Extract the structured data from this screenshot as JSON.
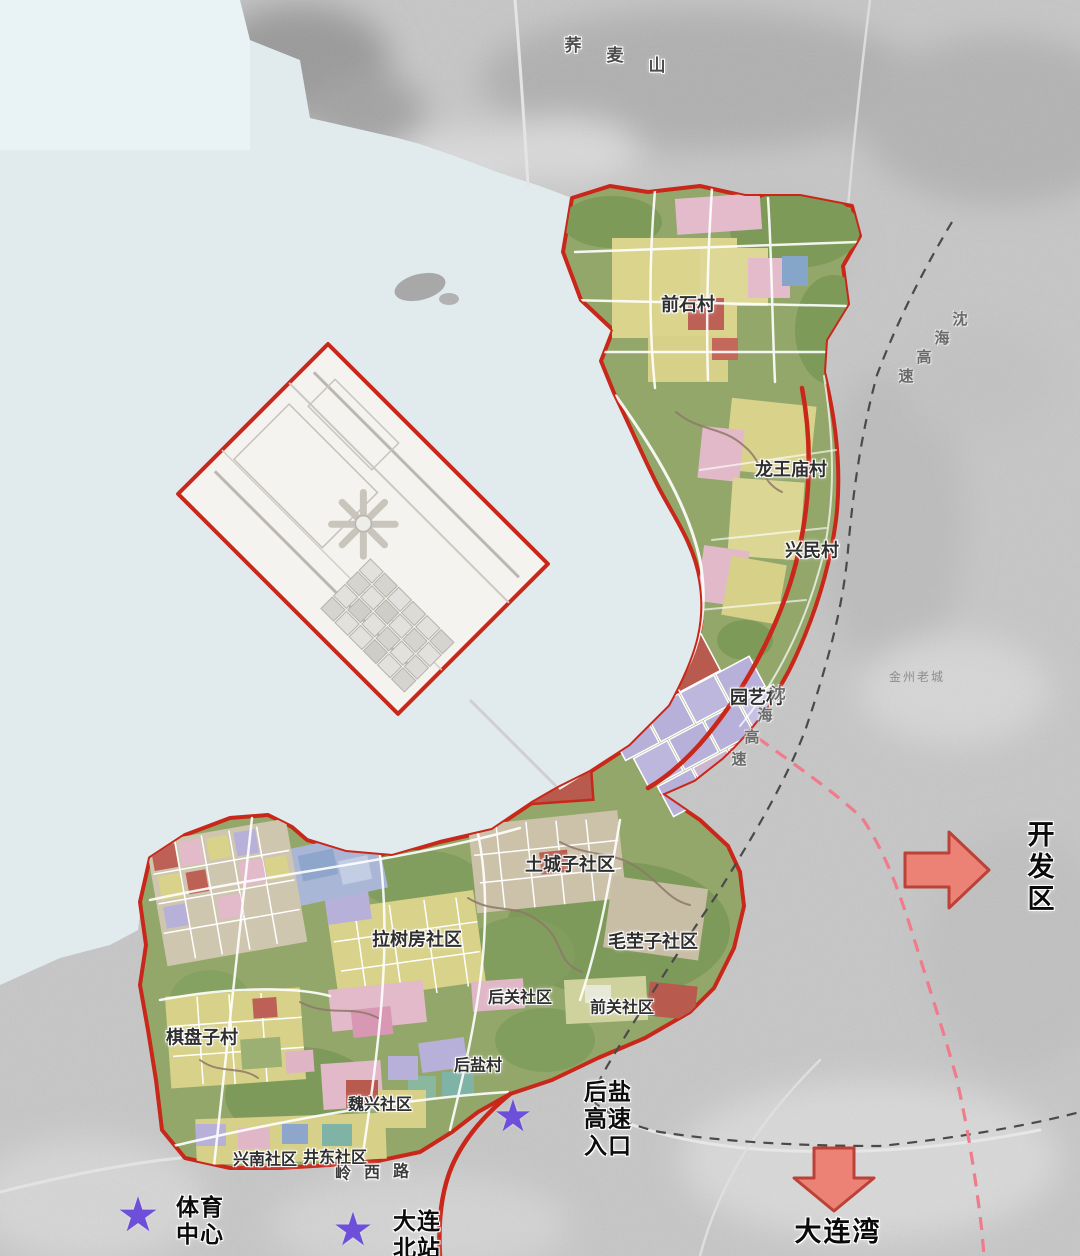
{
  "map": {
    "description_labels": {
      "note": "urban planning map over satellite imagery"
    },
    "labels": [
      {
        "id": "qiaomai-mountain",
        "text": "荞麦山",
        "x": 573,
        "y": 46,
        "cls": "mountain",
        "char_dx": 42,
        "char_dy": 10
      },
      {
        "id": "qianshi-village",
        "text": "前石村",
        "x": 688,
        "y": 305,
        "cls": "zone"
      },
      {
        "id": "longwangmiao-village",
        "text": "龙王庙村",
        "x": 791,
        "y": 470,
        "cls": "zone"
      },
      {
        "id": "xingmin-village",
        "text": "兴民村",
        "x": 812,
        "y": 551,
        "cls": "zone"
      },
      {
        "id": "yuanyi-village",
        "text": "园艺村",
        "x": 757,
        "y": 698,
        "cls": "zone"
      },
      {
        "id": "shenhai-expressway-north",
        "text": "沈海高速",
        "x": 960,
        "y": 320,
        "cls": "road-grey",
        "char_dx": -18,
        "char_dy": 19
      },
      {
        "id": "shenhai-expressway-mid",
        "text": "沈海高速",
        "x": 778,
        "y": 694,
        "cls": "road-grey",
        "char_dx": -13,
        "char_dy": 22
      },
      {
        "id": "jinzhou-old-town",
        "text": "金州老城",
        "x": 917,
        "y": 677,
        "cls": "faint"
      },
      {
        "id": "tuchengzi-community",
        "text": "土城子社区",
        "x": 570,
        "y": 865,
        "cls": "zone"
      },
      {
        "id": "maoyingzi-community",
        "text": "毛茔子社区",
        "x": 653,
        "y": 942,
        "cls": "zone"
      },
      {
        "id": "lashufang-community",
        "text": "拉树房社区",
        "x": 417,
        "y": 940,
        "cls": "zone"
      },
      {
        "id": "houguan-community",
        "text": "后关社区",
        "x": 520,
        "y": 998,
        "cls": "zone-sm"
      },
      {
        "id": "qianguan-community",
        "text": "前关社区",
        "x": 622,
        "y": 1008,
        "cls": "zone-sm"
      },
      {
        "id": "qipanzi-village",
        "text": "棋盘子村",
        "x": 202,
        "y": 1038,
        "cls": "zone"
      },
      {
        "id": "houyan-village",
        "text": "后盐村",
        "x": 478,
        "y": 1066,
        "cls": "zone-sm"
      },
      {
        "id": "weixing-community",
        "text": "魏兴社区",
        "x": 380,
        "y": 1105,
        "cls": "zone-sm"
      },
      {
        "id": "xingnan-community",
        "text": "兴南社区",
        "x": 265,
        "y": 1160,
        "cls": "zone-sm"
      },
      {
        "id": "jingdong-community",
        "text": "井东社区",
        "x": 335,
        "y": 1158,
        "cls": "zone-sm"
      },
      {
        "id": "lingxi-road",
        "text": "岭西路",
        "x": 343,
        "y": 1174,
        "cls": "road-red",
        "char_dx": 29,
        "char_dy": -1
      },
      {
        "id": "houyan-expressway-entrance",
        "text": "后盐\n高速\n入口",
        "x": 608,
        "y": 1120,
        "cls": "landmark"
      },
      {
        "id": "sports-center",
        "text": "体育\n中心",
        "x": 200,
        "y": 1222,
        "cls": "landmark"
      },
      {
        "id": "dalian-north-station",
        "text": "大连\n北站",
        "x": 417,
        "y": 1236,
        "cls": "landmark"
      },
      {
        "id": "development-zone",
        "text": "开发区",
        "x": 1042,
        "y": 868,
        "cls": "dest"
      },
      {
        "id": "dalian-bay",
        "text": "大连湾",
        "x": 838,
        "y": 1233,
        "cls": "dest"
      }
    ],
    "stars": [
      {
        "id": "sports-center-star",
        "x": 138,
        "y": 1215,
        "size": 48
      },
      {
        "id": "dalian-north-station-star",
        "x": 353,
        "y": 1229,
        "size": 46
      },
      {
        "id": "houyan-entrance-star",
        "x": 513,
        "y": 1117,
        "size": 44
      }
    ],
    "arrows": [
      {
        "id": "development-zone-arrow",
        "direction": "right"
      },
      {
        "id": "dalian-bay-arrow",
        "direction": "down"
      }
    ],
    "icons": {
      "star": "★",
      "arrow_right": "block-arrow-right",
      "arrow_down": "block-arrow-down"
    },
    "colors": {
      "sea": "#e1ebee",
      "satellite_land": "#c6c6c6",
      "planning_boundary_red": "#c9271a",
      "zone_green": "#93a76b",
      "parcel_yellow": "#d8d28a",
      "parcel_pink": "#e3bac9",
      "parcel_lavender": "#b7b0d9",
      "parcel_redbrown": "#b85a4e",
      "star_purple": "#6e4fd9",
      "arrow_salmon": "#ec8176",
      "dashed_pink": "#ef7b8b",
      "dashed_black": "#4a4a4a"
    }
  }
}
